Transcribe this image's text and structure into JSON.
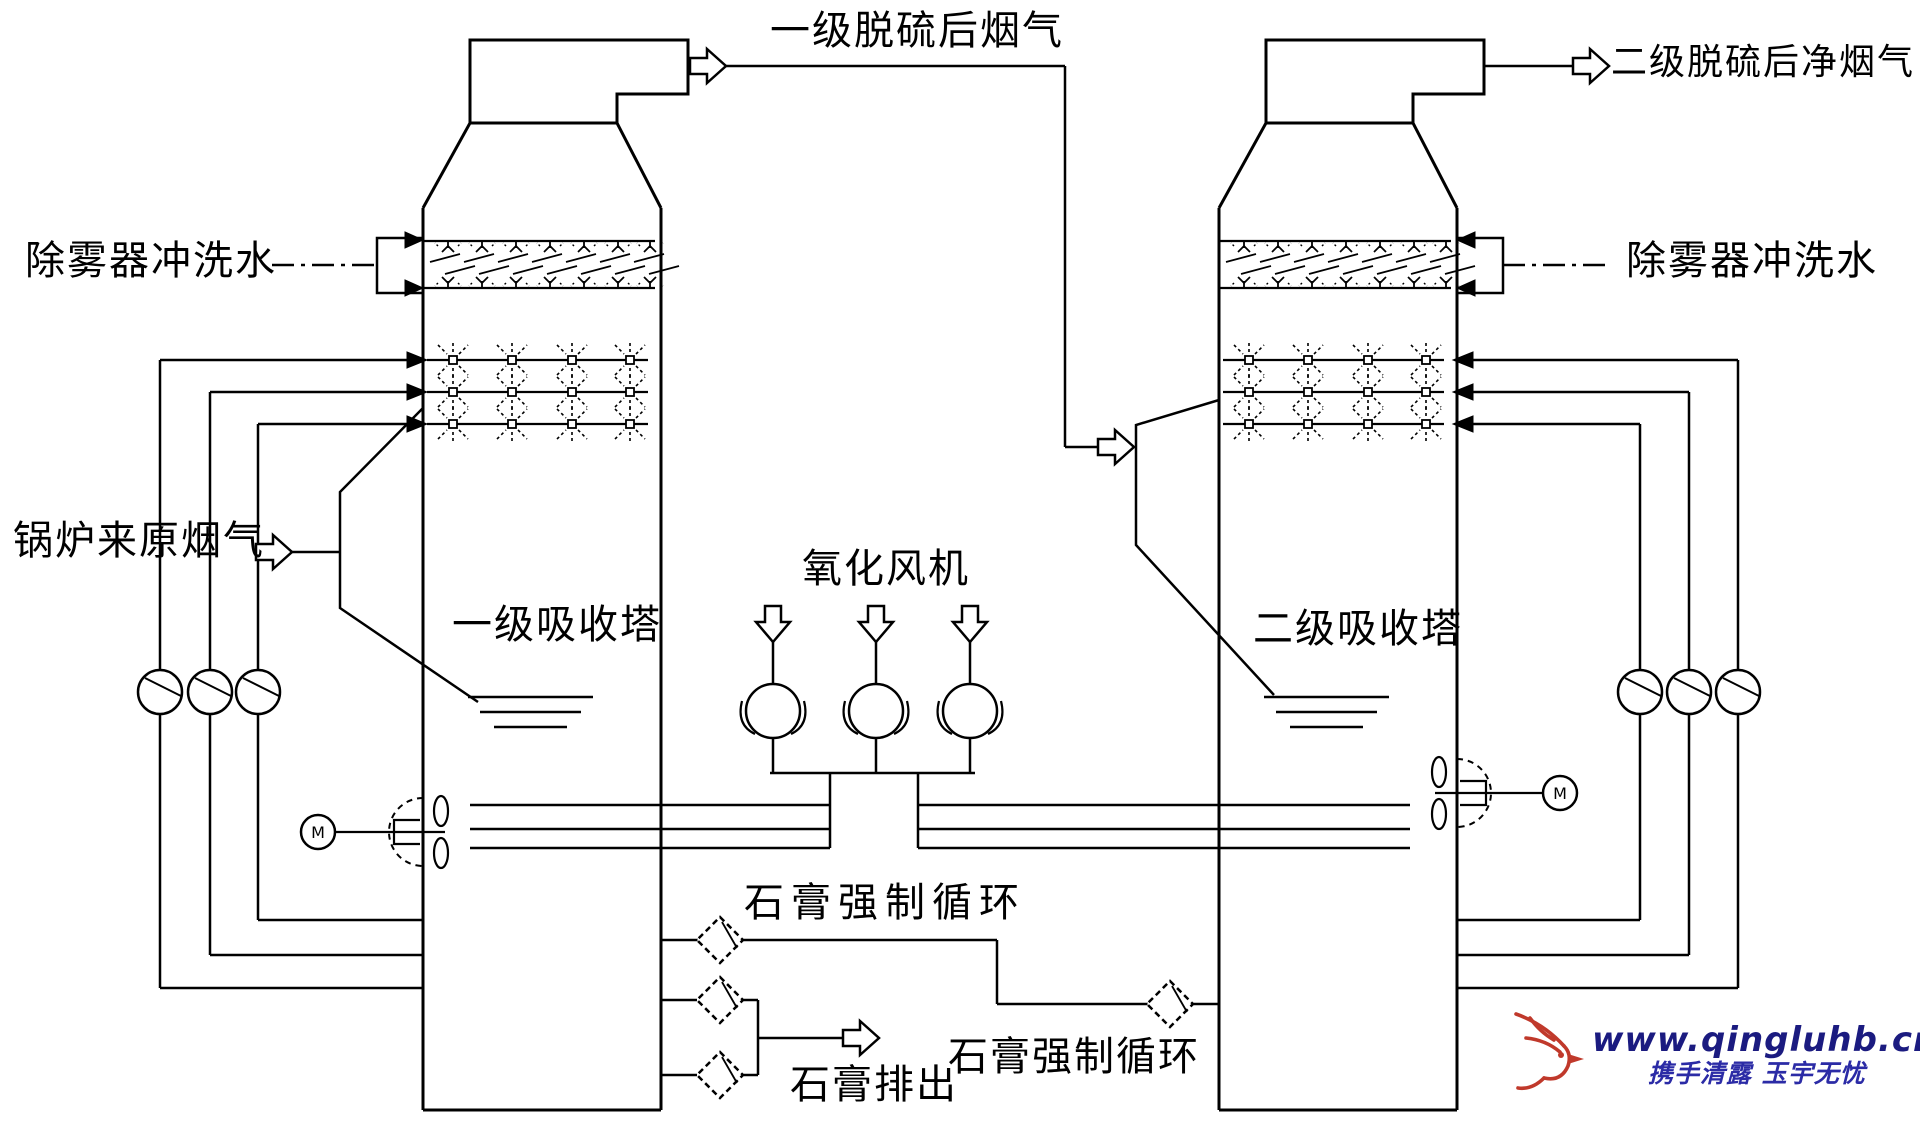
{
  "labels": {
    "stage1_outlet_gas": "一级脱硫后烟气",
    "stage2_outlet_gas": "二级脱硫后净烟气",
    "demister_flush_left": "除雾器冲洗水",
    "demister_flush_right": "除雾器冲洗水",
    "boiler_raw_gas": "锅炉来原烟气",
    "tower1_name": "一级吸收塔",
    "tower2_name": "二级吸收塔",
    "oxidation_fan": "氧化风机",
    "gypsum_forced_circulation_1": "石膏强制循环",
    "gypsum_forced_circulation_2": "石膏强制循环",
    "gypsum_discharge": "石膏排出",
    "agitator_motor_symbol": "M"
  },
  "watermark": {
    "website": "www.qingluhb.cn",
    "slogan": "携手清露 玉宇无忧",
    "website_color": "#1b1b80",
    "slogan_color": "#2b2ba6",
    "bird_color": "#c0392b"
  },
  "colors": {
    "diagram_line": "#000000",
    "background": "#ffffff"
  }
}
